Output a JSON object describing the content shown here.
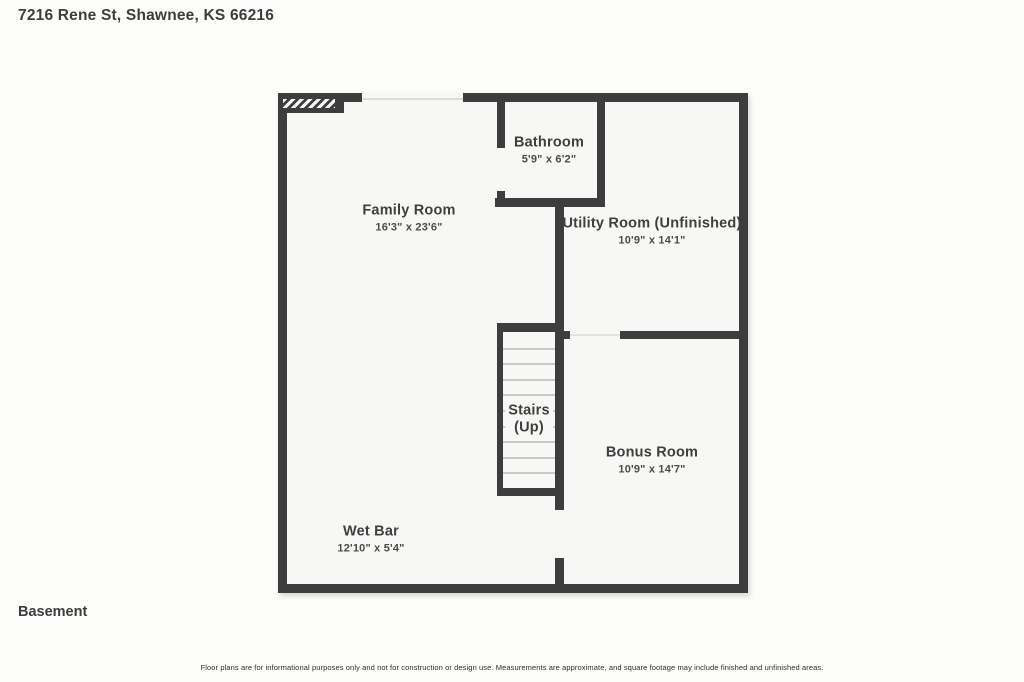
{
  "header": {
    "address": "7216 Rene St, Shawnee, KS 66216"
  },
  "floor_label": "Basement",
  "disclaimer": "Floor plans are for informational purposes only and not for construction or design use. Measurements are approximate, and square footage may include finished and unfinished areas.",
  "rooms": [
    {
      "name": "Family Room",
      "dimensions": "16'3\" x 23'6\""
    },
    {
      "name": "Bathroom",
      "dimensions": "5'9\" x 6'2\""
    },
    {
      "name": "Utility Room (Unfinished)",
      "dimensions": "10'9\" x 14'1\""
    },
    {
      "name": "Stairs",
      "name_line2": "(Up)",
      "dimensions": ""
    },
    {
      "name": "Bonus Room",
      "dimensions": "10'9\" x 14'7\""
    },
    {
      "name": "Wet Bar",
      "dimensions": "12'10\" x 5'4\""
    }
  ],
  "colors": {
    "wall": "#3d3d3d",
    "interior": "#f7f7f5",
    "background": "#fcfcfb",
    "text": "#3f3f3f"
  }
}
